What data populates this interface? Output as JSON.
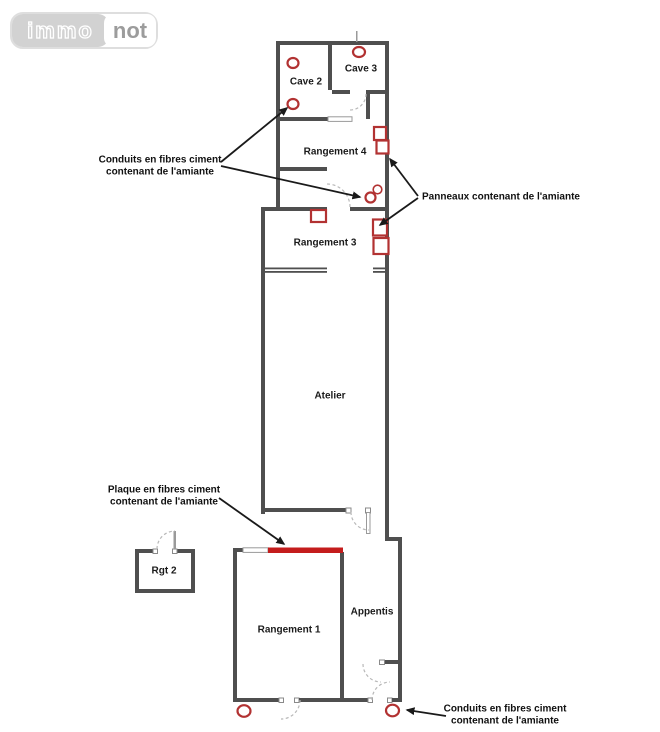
{
  "brand": {
    "left": "immo",
    "right": "not"
  },
  "rooms": {
    "cave2": "Cave 2",
    "cave3": "Cave 3",
    "rangement4": "Rangement 4",
    "rangement3": "Rangement 3",
    "atelier": "Atelier",
    "rgt2": "Rgt 2",
    "rangement1": "Rangement 1",
    "appentis": "Appentis"
  },
  "annotations": {
    "conduits_left": {
      "line1": "Conduits en fibres ciment",
      "line2": "contenant de l'amiante"
    },
    "panneaux": {
      "line1": "Panneaux contenant de l'amiante"
    },
    "plaque": {
      "line1": "Plaque en fibres ciment",
      "line2": "contenant de l'amiante"
    },
    "conduits_bottom": {
      "line1": "Conduits en fibres ciment",
      "line2": "contenant de l'amiante"
    }
  },
  "markers": {
    "conduit_circles": [
      "cave-2-upper",
      "cave-3",
      "cave-2-lower",
      "rangement-4-right-a",
      "rangement-4-right-b",
      "exterior-bottom-left",
      "appentis-bottom-right"
    ],
    "panneau_rectangles": [
      "rangement-4-wall-upper",
      "rangement-4-wall-lower",
      "rangement-3-top-wall",
      "rangement-3-right-upper",
      "rangement-3-right-lower"
    ],
    "plaque_segment": "rangement-1-top-wall"
  },
  "colors": {
    "wall": "#4f4f4f",
    "marker_red": "#b23232",
    "plaque_red": "#c41c1c",
    "arrow": "#1a1a1a",
    "door_arc": "#b8b8b8",
    "logo_gray": "#d2d2d2",
    "logo_border": "#dedede",
    "logo_text": "#9c9c9c"
  }
}
